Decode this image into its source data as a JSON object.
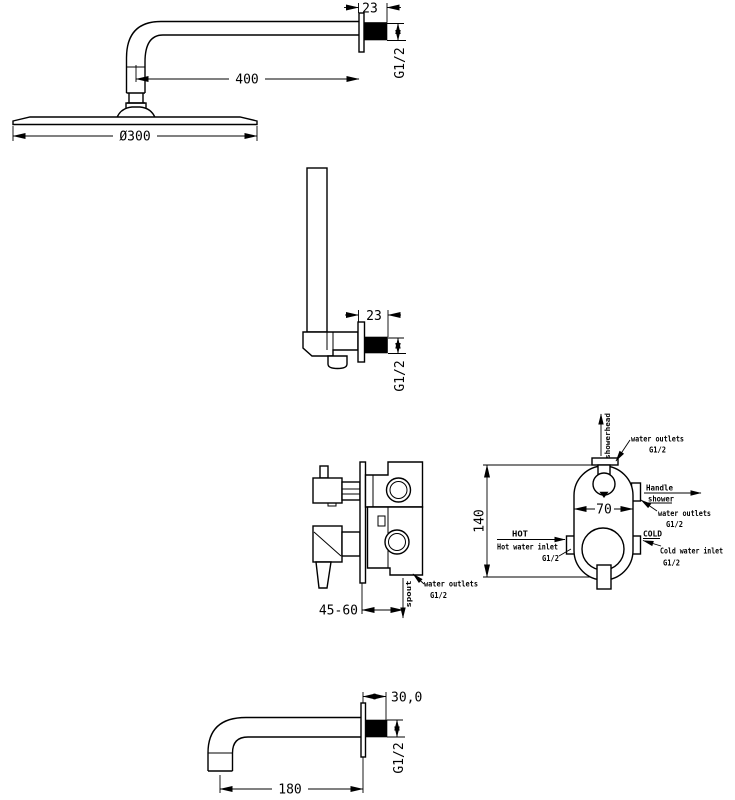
{
  "page": {
    "background": "#ffffff",
    "line_color": "#000000"
  },
  "head_assembly": {
    "arm_length": "400",
    "head_diameter": "Ø300",
    "flange_depth": "23",
    "thread": "G1/2"
  },
  "handshower_outlet": {
    "flange_depth": "23",
    "thread": "G1/2"
  },
  "valve_side": {
    "install_depth": "45-60",
    "outlet_label": "water outlets",
    "outlet_thread": "G1/2",
    "outlet_direction": "spout"
  },
  "valve_front": {
    "height": "140",
    "width": "70",
    "top_outlet_label": "water outlets",
    "top_outlet_thread": "G1/2",
    "top_outlet_direction": "showerhead",
    "handle_shower_line1": "Handle",
    "handle_shower_line2": "shower",
    "right_outlet_label": "water outlets",
    "right_outlet_thread": "G1/2",
    "hot_tag": "HOT",
    "hot_label": "Hot water inlet",
    "hot_thread": "G1/2",
    "cold_tag": "COLD",
    "cold_label": "Cold water inlet",
    "cold_thread": "G1/2"
  },
  "spout": {
    "length": "180",
    "flange_depth": "30,0",
    "thread": "G1/2"
  }
}
